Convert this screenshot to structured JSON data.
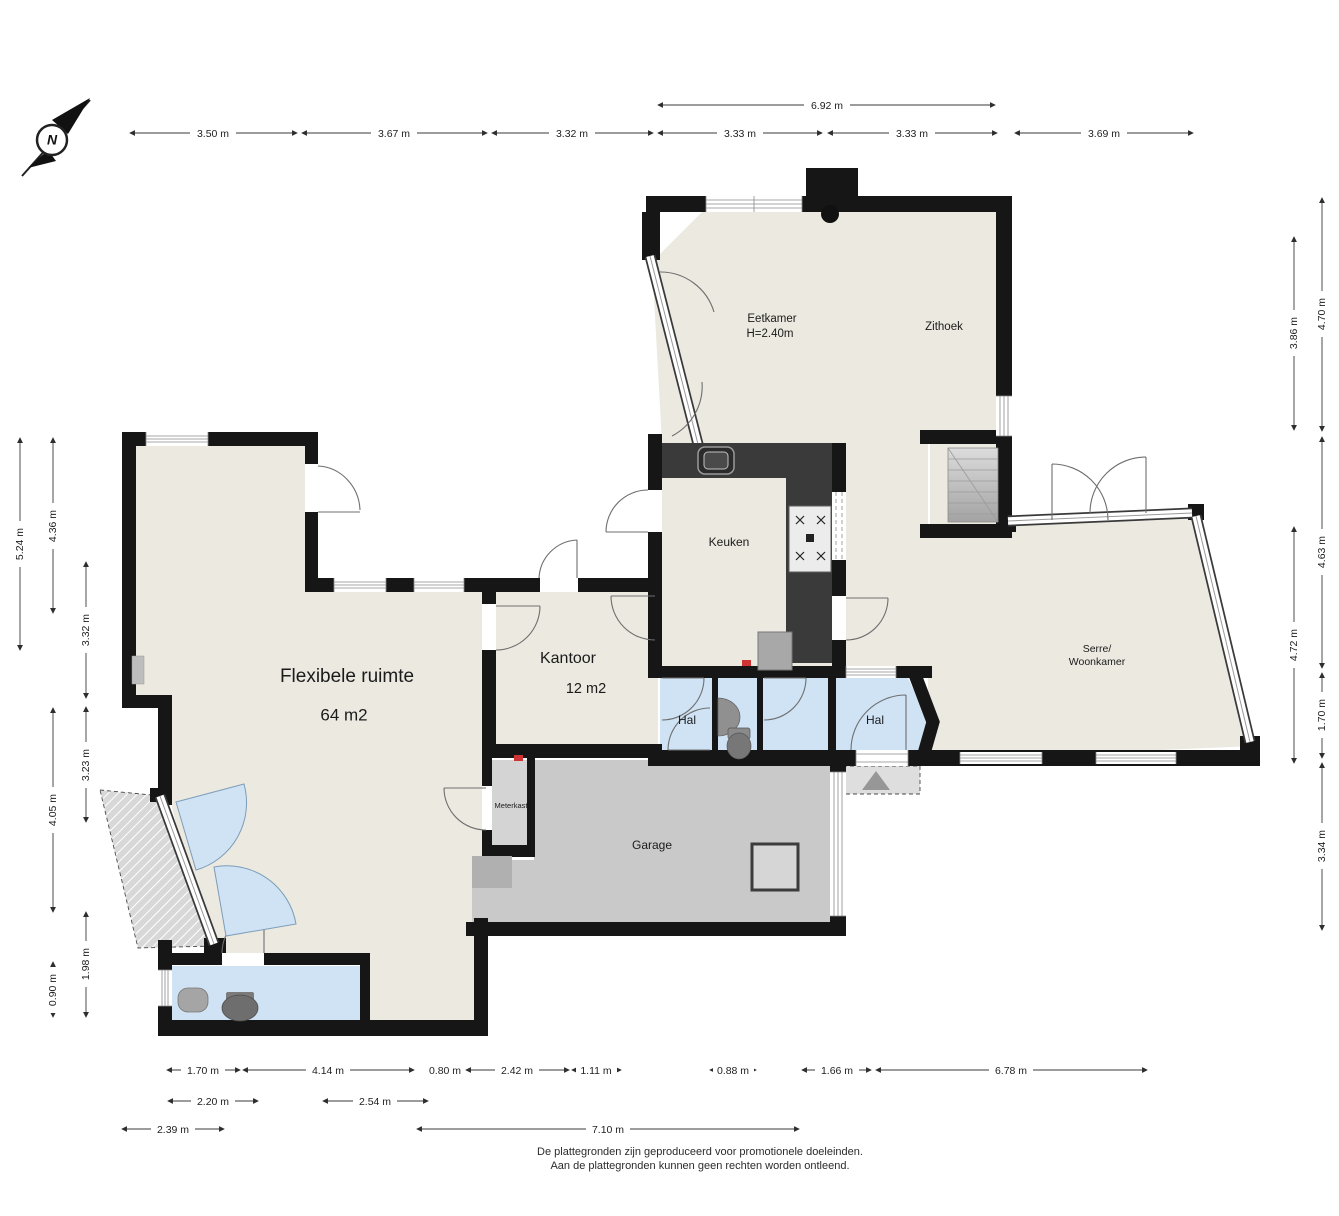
{
  "compass": {
    "north_label": "N"
  },
  "rooms": {
    "eetkamer": {
      "name": "Eetkamer",
      "height_note": "H=2.40m"
    },
    "zithoek": {
      "name": "Zithoek"
    },
    "keuken": {
      "name": "Keuken"
    },
    "kantoor": {
      "name": "Kantoor",
      "area": "12 m2"
    },
    "flexibele_ruimte": {
      "name": "Flexibele ruimte",
      "area": "64 m2"
    },
    "hal_west": {
      "name": "Hal"
    },
    "hal_east": {
      "name": "Hal"
    },
    "serre_woonkamer": {
      "name_line1": "Serre/",
      "name_line2": "Woonkamer"
    },
    "garage": {
      "name": "Garage"
    },
    "meterkast": {
      "name": "Meterkast"
    }
  },
  "dims": {
    "top_overall": "6.92 m",
    "top": [
      "3.50 m",
      "3.67 m",
      "3.32 m",
      "3.33 m",
      "3.33 m",
      "3.69 m"
    ],
    "left": [
      "5.24 m",
      "4.36 m",
      "3.32 m",
      "3.23 m",
      "4.05 m",
      "1.98 m",
      "0.90 m"
    ],
    "right": [
      "3.86 m",
      "4.70 m",
      "4.63 m",
      "4.72 m",
      "1.70 m",
      "3.34 m"
    ],
    "bottom_row1": [
      "1.70 m",
      "4.14 m",
      "0.80 m",
      "2.42 m",
      "1.11 m",
      "0.88 m",
      "1.66 m",
      "6.78 m"
    ],
    "bottom_row2": [
      "2.20 m",
      "2.54 m"
    ],
    "bottom_row3": [
      "2.39 m",
      "7.10 m"
    ]
  },
  "footer": {
    "line1": "De plattegronden zijn geproduceerd voor promotionele doeleinden.",
    "line2": "Aan de plattegronden kunnen geen rechten worden ontleend."
  },
  "colors": {
    "wall": "#161616",
    "floor": "#ebe9e0",
    "floor_wet": "#cfe3f4",
    "floor_garage": "#c9c9c9",
    "counter": "#3a3a3a",
    "detector_red": "#cf3333"
  }
}
